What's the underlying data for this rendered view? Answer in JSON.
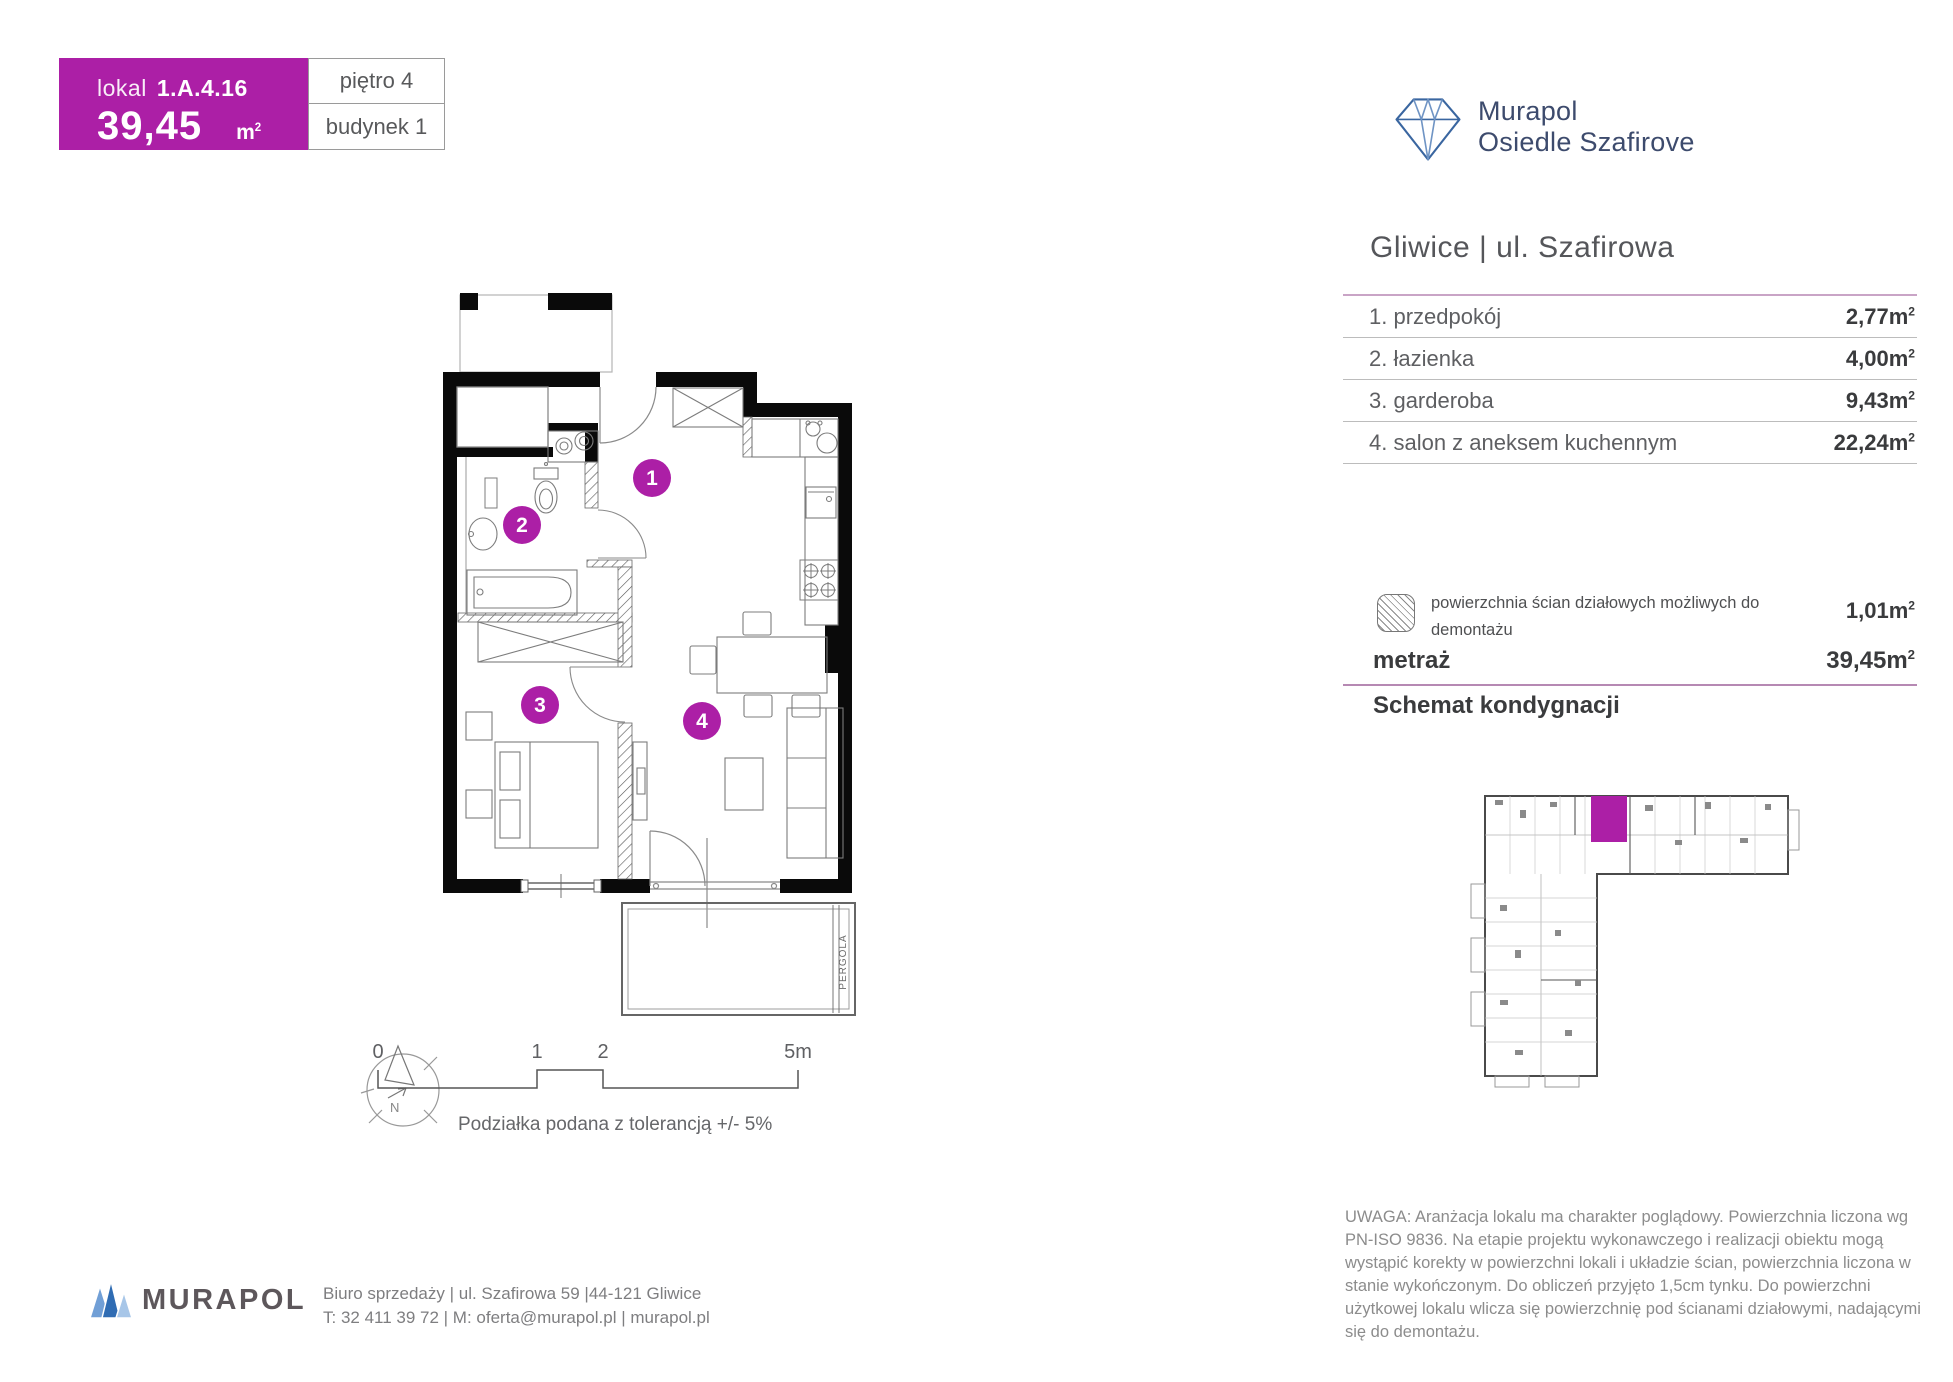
{
  "colors": {
    "accent": "#AC1FA6",
    "navy": "#3d4b6d"
  },
  "unit": {
    "lokal_label": "lokal",
    "number": "1.A.4.16",
    "area": "39,45",
    "floor": "piętro 4",
    "building": "budynek 1"
  },
  "units": {
    "sq": "m",
    "sup": "2"
  },
  "brand": {
    "line1": "Murapol",
    "line2": "Osiedle Szafirove"
  },
  "location": "Gliwice | ul. Szafirowa",
  "rooms": [
    {
      "label": "1. przedpokój",
      "area": "2,77"
    },
    {
      "label": "2. łazienka",
      "area": "4,00"
    },
    {
      "label": "3. garderoba",
      "area": "9,43"
    },
    {
      "label": "4. salon z aneksem kuchennym",
      "area": "22,24"
    }
  ],
  "partition": {
    "label": "powierzchnia ścian działowych możliwych do demontażu",
    "area": "1,01"
  },
  "metraz": {
    "label": "metraż",
    "value": "39,45"
  },
  "schematic_title": "Schemat kondygnacji",
  "plan": {
    "numbers": [
      "1",
      "2",
      "3",
      "4"
    ],
    "pergola": "PERGOLA",
    "compass": "N",
    "scale": {
      "t0": "0",
      "t1": "1",
      "t2": "2",
      "t5": "5m"
    },
    "tolerance": "Podziałka podana z tolerancją +/- 5%"
  },
  "footer": {
    "brand": "MURAPOL",
    "line1": "Biuro sprzedaży | ul. Szafirowa 59 |44-121 Gliwice",
    "line2": "T: 32 411 39 72 | M: oferta@murapol.pl | murapol.pl"
  },
  "disclaimer": "UWAGA: Aranżacja lokalu ma charakter poglądowy. Powierzchnia liczona wg PN-ISO 9836. Na etapie projektu wykonawczego i realizacji obiektu mogą wystąpić korekty w powierzchni lokali i układzie ścian, powierzchnia liczona w stanie wykończonym. Do obliczeń przyjęto 1,5cm tynku. Do powierzchni użytkowej lokalu wlicza się powierzchnię pod ścianami działowymi, nadającymi się do demontażu."
}
